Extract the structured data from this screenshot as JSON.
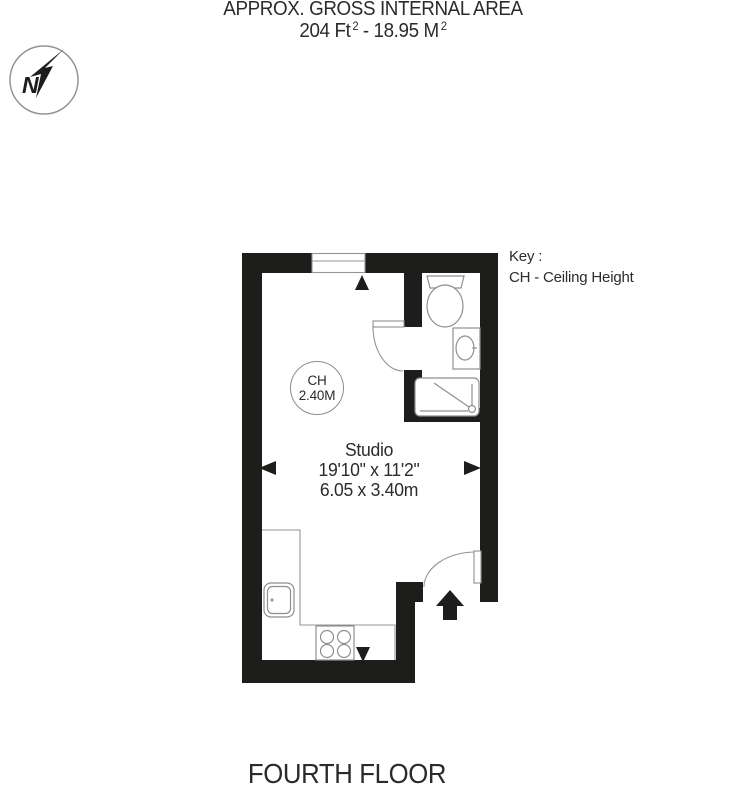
{
  "title": "APPROX. GROSS INTERNAL AREA",
  "area": {
    "imperial": "204 Ft",
    "imperial_sup": "2",
    "separator": "-",
    "metric": "18.95 M",
    "metric_sup": "2"
  },
  "compass": {
    "letter": "N"
  },
  "key": {
    "label": "Key :",
    "ch_entry": "CH - Ceiling Height"
  },
  "room": {
    "ceiling_label": "CH",
    "ceiling_value": "2.40M",
    "name": "Studio",
    "dimensions_imperial": "19'10\" x 11'2\"",
    "dimensions_metric": "6.05 x 3.40m"
  },
  "floor": "FOURTH FLOOR",
  "colors": {
    "wall": "#1d1d1b",
    "thin_line": "#949494",
    "fixture_line": "#8f8f8f",
    "text": "#2b2b29"
  }
}
